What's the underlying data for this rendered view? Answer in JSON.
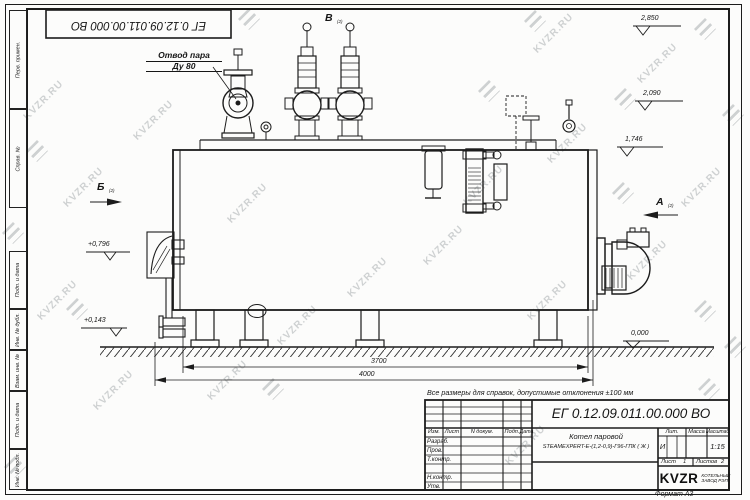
{
  "watermark": {
    "text": "KVZR.RU"
  },
  "frame": {
    "stamp": "ЕГ 0.12.09.011.00.000  ВО",
    "format": "Формат А3",
    "columns": {
      "c1": "Перв. примен.",
      "c2": "Справ. №",
      "c3": "Подп. и дата",
      "c4": "Инв. № дубл.",
      "c5": "Взам. инв. №",
      "c6": "Подп. и дата",
      "c7": "Инв. № подл."
    }
  },
  "drawing": {
    "callout_line1": "Отвод пара",
    "callout_line2": "Ду 80",
    "note": "Все размеры для справок,  допустимые отклонения  ±100 мм",
    "views": {
      "b": "Б",
      "v": "В",
      "a": "А",
      "ref": "(2)"
    },
    "levels": {
      "l2850": "2,850",
      "l2090": "2,090",
      "l1746": "1,746",
      "l0000": "0,000",
      "l0796": "+0,796",
      "l0143": "+0,143"
    },
    "dims": {
      "d3700": "3700",
      "d4000": "4000"
    }
  },
  "title_block": {
    "designation": "ЕГ 0.12.09.011.00.000  ВО",
    "product_line1": "Котел паровой",
    "product_line2": "STEAMEXPERT-Е-(1,2-0,9)-Г96-ГПК ( Ж )",
    "col_izm": "Изм.",
    "col_list": "Лист",
    "col_ndoc": "N докум.",
    "col_podp": "Подп.",
    "col_data": "Дата",
    "row_razrab": "Разраб.",
    "row_prov": "Пров.",
    "row_tkontr": "Т.контр.",
    "row_nkontr": "Н.контр.",
    "row_utv": "Утв.",
    "lit_label": "Лит.",
    "lit_value": "И",
    "massa_label": "Масса",
    "masshtab_label": "Масштаб",
    "scale": "1:15",
    "list_label": "Лист",
    "list_value": "1",
    "listov_label": "Листов",
    "listov_value": "2",
    "logo": "KVZR",
    "logo_sub1": "КОТЕЛЬНЫЙ",
    "logo_sub2": "ЗАВОД РЭП"
  }
}
